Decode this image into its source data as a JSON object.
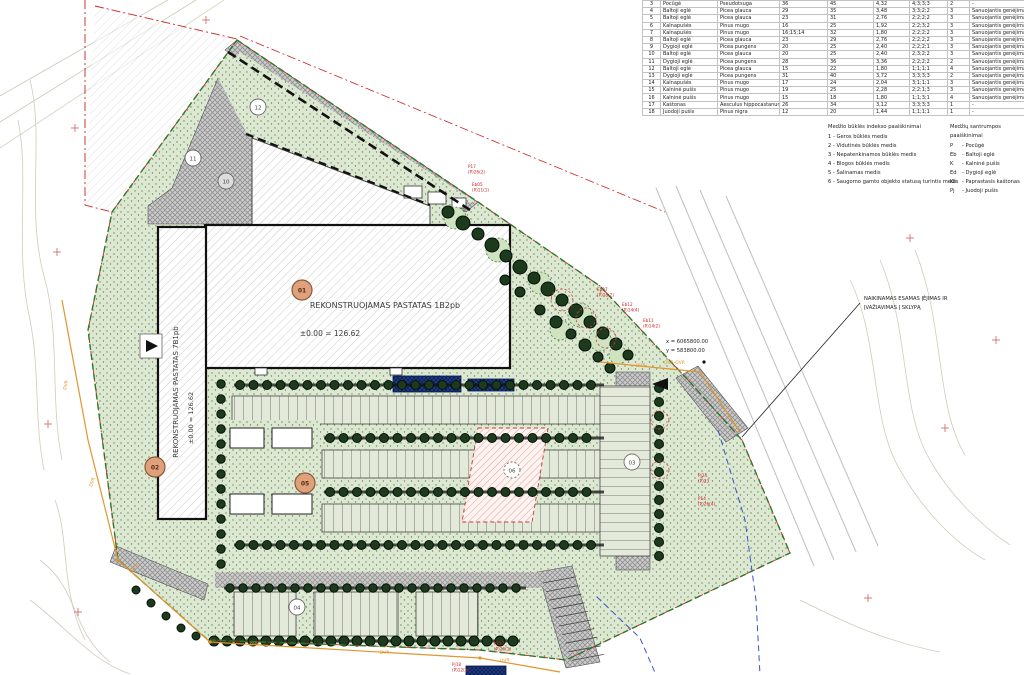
{
  "colors": {
    "badge_orange": "#dfa07c",
    "boundary_green": "#2a7a2a",
    "marker_red": "#cc2222",
    "utility_orange": "#e0962d",
    "water_blue": "#24408e",
    "lawn_green": "#dde8d2"
  },
  "table": {
    "rows": [
      {
        "nr": "3",
        "name": "Pocūgė",
        "latin": "Pseudotsuga",
        "d1": "36",
        "d2": "45",
        "d3": "4,32",
        "idx": "4;3;3;3",
        "grade": "2",
        "note": "-"
      },
      {
        "nr": "4",
        "name": "Baltoji eglė",
        "latin": "Picea glauca",
        "d1": "29",
        "d2": "35",
        "d3": "3,48",
        "idx": "3;3;2;2",
        "grade": "3",
        "note": "Sanuojantis genėjimas"
      },
      {
        "nr": "5",
        "name": "Baltoji eglė",
        "latin": "Picea glauca",
        "d1": "23",
        "d2": "31",
        "d3": "2,76",
        "idx": "2;2;2;2",
        "grade": "3",
        "note": "Sanuojantis genėjimas"
      },
      {
        "nr": "6",
        "name": "Kalnapušės",
        "latin": "Pinus mugo",
        "d1": "16",
        "d2": "25",
        "d3": "1,92",
        "idx": "2;2;3;2",
        "grade": "3",
        "note": "Sanuojantis genėjimas"
      },
      {
        "nr": "7",
        "name": "Kalnapušės",
        "latin": "Pinus mugo",
        "d1": "16;15;14",
        "d2": "32",
        "d3": "1,80",
        "idx": "2;2;2;2",
        "grade": "3",
        "note": "Sanuojantis genėjimas"
      },
      {
        "nr": "8",
        "name": "Baltoji eglė",
        "latin": "Picea glauca",
        "d1": "23",
        "d2": "29",
        "d3": "2,76",
        "idx": "2;2;2;2",
        "grade": "3",
        "note": "Sanuojantis genėjimas"
      },
      {
        "nr": "9",
        "name": "Dygioji eglė",
        "latin": "Picea pungens",
        "d1": "20",
        "d2": "25",
        "d3": "2,40",
        "idx": "2;2;2;1",
        "grade": "3",
        "note": "Sanuojantis genėjimas"
      },
      {
        "nr": "10",
        "name": "Baltoji eglė",
        "latin": "Picea glauca",
        "d1": "20",
        "d2": "25",
        "d3": "2,40",
        "idx": "2;3;2;2",
        "grade": "3",
        "note": "Sanuojantis genėjimas"
      },
      {
        "nr": "11",
        "name": "Dygioji eglė",
        "latin": "Picea pungens",
        "d1": "28",
        "d2": "36",
        "d3": "3,36",
        "idx": "2;2;2;2",
        "grade": "2",
        "note": "Sanuojantis genėjimas"
      },
      {
        "nr": "12",
        "name": "Baltoji eglė",
        "latin": "Picea glauca",
        "d1": "15",
        "d2": "22",
        "d3": "1,80",
        "idx": "1;1;1;1",
        "grade": "4",
        "note": "Sanuojantis genėjimas"
      },
      {
        "nr": "13",
        "name": "Dygioji eglė",
        "latin": "Picea pungens",
        "d1": "31",
        "d2": "40",
        "d3": "3,72",
        "idx": "3;3;3;3",
        "grade": "2",
        "note": "Sanuojantis genėjimas"
      },
      {
        "nr": "14",
        "name": "Kalnapušės",
        "latin": "Pinus mugo",
        "d1": "17",
        "d2": "24",
        "d3": "2,04",
        "idx": "3;1;1;1",
        "grade": "3",
        "note": "Sanuojantis genėjimas"
      },
      {
        "nr": "15",
        "name": "Kalninė pušis",
        "latin": "Pinus mugo",
        "d1": "19",
        "d2": "25",
        "d3": "2,28",
        "idx": "2;2;1;3",
        "grade": "3",
        "note": "Sanuojantis genėjimas"
      },
      {
        "nr": "16",
        "name": "Kalninė pušis",
        "latin": "Pinus mugo",
        "d1": "15",
        "d2": "18",
        "d3": "1,80",
        "idx": "1;1;3;1",
        "grade": "4",
        "note": "Sanuojantis genėjimas"
      },
      {
        "nr": "17",
        "name": "Kaštonas",
        "latin": "Aesculus hippocastanum",
        "d1": "26",
        "d2": "34",
        "d3": "3,12",
        "idx": "3;3;3;3",
        "grade": "1",
        "note": "-"
      },
      {
        "nr": "18",
        "name": "Juodoji pušis",
        "latin": "Pinus nigra",
        "d1": "12",
        "d2": "20",
        "d3": "1,44",
        "idx": "1;1;1;1",
        "grade": "1",
        "note": "-"
      }
    ]
  },
  "legend_condition": {
    "title": "Medžio būklės indekso paaiškinimai",
    "items": [
      "1 - Geros būklės medis",
      "2 - Vidutinės būklės medis",
      "3 - Nepatenkinamos būklės medis",
      "4 - Blogos būklės medis",
      "5 - Šalinamas medis",
      "6 - Saugomo gamto objekto statusą turintis medis"
    ]
  },
  "legend_abbrev": {
    "title": "Medžių santrumpos paaiškinimai",
    "items": [
      {
        "abbr": "P",
        "name": "Pocūgė"
      },
      {
        "abbr": "Eb",
        "name": "Baltoji eglė"
      },
      {
        "abbr": "K",
        "name": "Kalninė pušis"
      },
      {
        "abbr": "Ed",
        "name": "Dygioji eglė"
      },
      {
        "abbr": "Kš",
        "name": "Paprastasis kaštonas"
      },
      {
        "abbr": "Pj",
        "name": "Juodoji pušis"
      }
    ]
  },
  "buildings": {
    "main": {
      "label": "REKONSTRUOJAMAS PASTATAS 1B2pb",
      "elevation": "±0.00 = 126.62"
    },
    "left": {
      "label": "REKONSTRUOJAMAS PASTATAS 7B1pb",
      "elevation": "±0.00 = 126.62"
    }
  },
  "badges": {
    "b01": "01",
    "b02": "02",
    "b03": "03",
    "b04": "04",
    "b05": "05",
    "b06": "06",
    "b10": "10",
    "b11": "11",
    "b12": "12"
  },
  "annotation": {
    "line1": "NAIKINAMAS ESAMAS ĮĖJIMAS IR",
    "line2": "ĮVAŽIAVIMAS Į SKLYPĄ"
  },
  "coords": {
    "x": "x = 6065800.00",
    "y": "y = 583800.00"
  },
  "utility": {
    "dvr": "DVR",
    "ovr": "OVR-OVR"
  },
  "tree_tags": [
    {
      "id": "Eb07",
      "spec": "(P)18(2)"
    },
    {
      "id": "Eb12",
      "spec": "(P)14(4)"
    },
    {
      "id": "Eb11",
      "spec": "(P)14(2)"
    },
    {
      "id": "Pj24",
      "spec": "(P)23"
    },
    {
      "id": "P14",
      "spec": "(P)26(4)"
    },
    {
      "id": "Kš17",
      "spec": "(P)26(1)"
    },
    {
      "id": "Pj18",
      "spec": "(P)12(1)"
    },
    {
      "id": "P17",
      "spec": "(P)26(2)"
    },
    {
      "id": "Eb05",
      "spec": "(P)11(1)"
    }
  ]
}
